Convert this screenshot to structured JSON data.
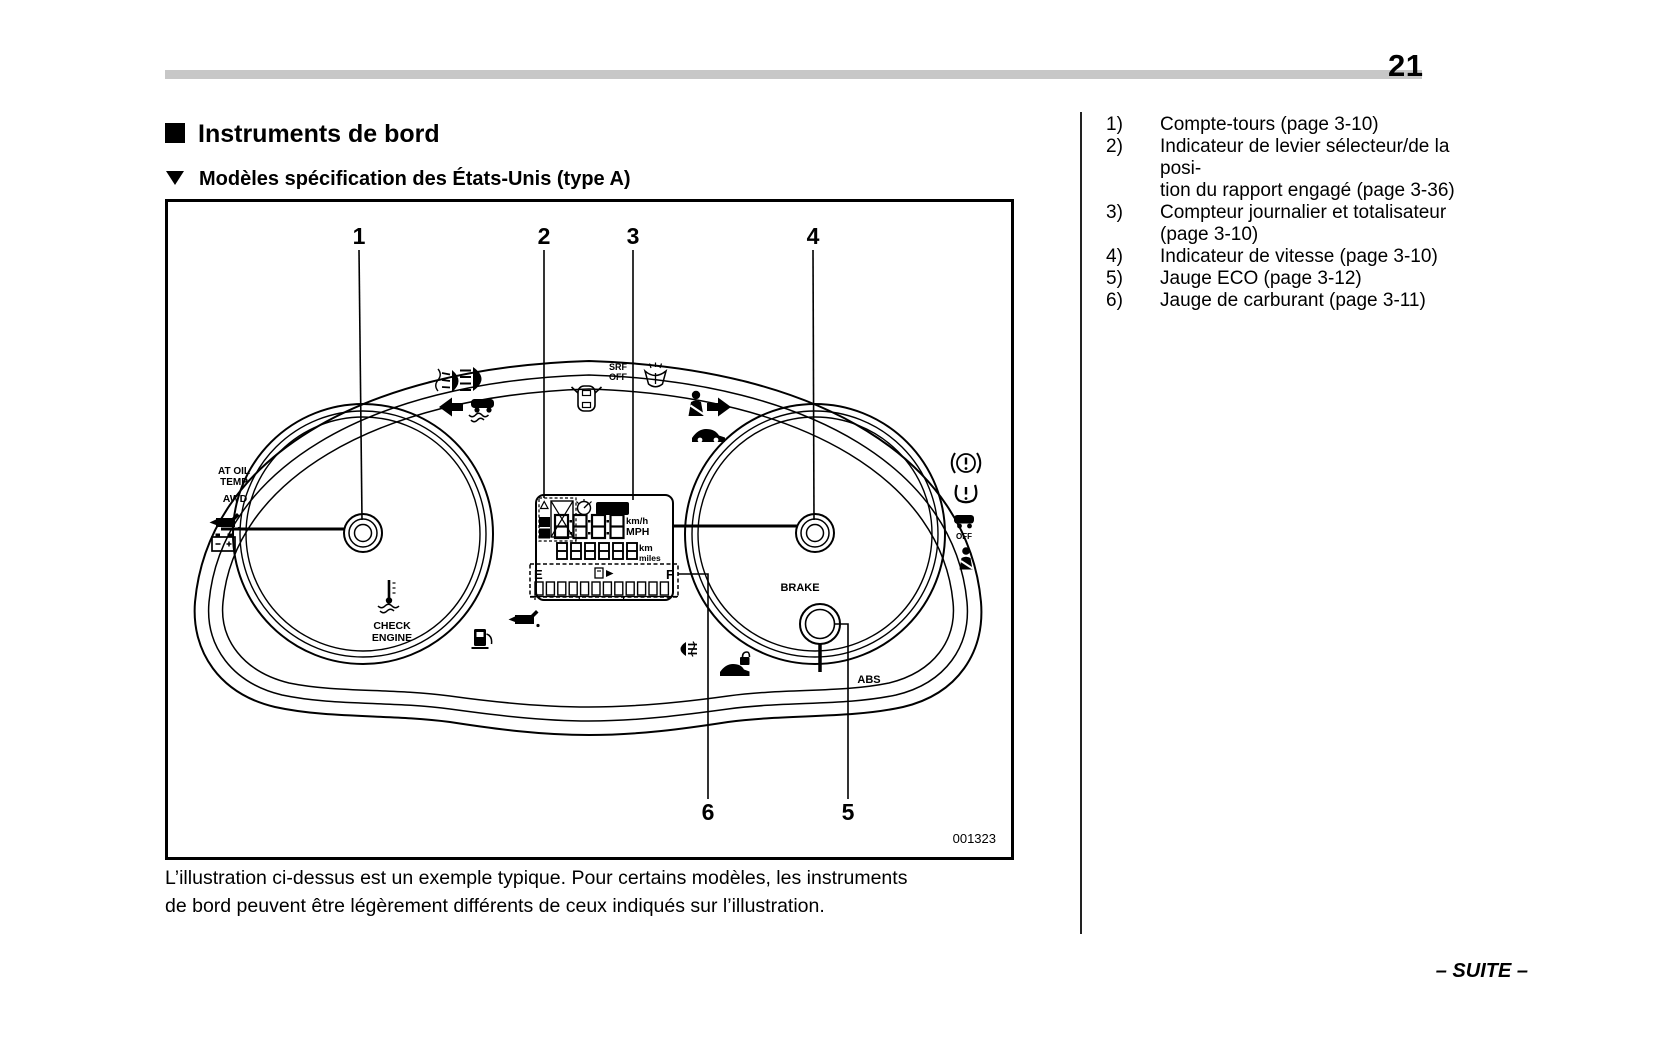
{
  "page": {
    "number": "21"
  },
  "header": {
    "title": "Instruments de bord",
    "subtitle": "Modèles spécification des États-Unis (type A)"
  },
  "figure": {
    "code": "001323",
    "callouts": [
      "1",
      "2",
      "3",
      "4",
      "5",
      "6"
    ],
    "labels": {
      "at_oil": "AT OIL",
      "temp": "TEMP",
      "awd": "AWD",
      "srf": "SRF",
      "srf_off": "OFF",
      "set": "SET",
      "trip_a": "A",
      "trip_b": "B",
      "kmh": "km/h",
      "mph": "MPH",
      "km": "km",
      "miles": "miles",
      "fuel_e": "E",
      "fuel_f": "F",
      "brake": "BRAKE",
      "abs": "ABS",
      "check": "CHECK",
      "engine": "ENGINE",
      "vdc_off": "OFF"
    }
  },
  "caption": {
    "line1": "L’illustration ci-dessus est un exemple typique. Pour certains modèles, les instruments",
    "line2": "de bord peuvent être légèrement différents de ceux indiqués sur l’illustration."
  },
  "reference_list": {
    "items": [
      {
        "num": "1)",
        "lines": [
          "Compte-tours (page 3-10)"
        ]
      },
      {
        "num": "2)",
        "lines": [
          "Indicateur de levier sélecteur/de la posi-",
          "tion du rapport engagé (page 3-36)"
        ]
      },
      {
        "num": "3)",
        "lines": [
          "Compteur journalier et totalisateur",
          "(page 3-10)"
        ]
      },
      {
        "num": "4)",
        "lines": [
          "Indicateur de vitesse (page 3-10)"
        ]
      },
      {
        "num": "5)",
        "lines": [
          "Jauge ECO (page 3-12)"
        ]
      },
      {
        "num": "6)",
        "lines": [
          "Jauge de carburant (page 3-11)"
        ]
      }
    ]
  },
  "footer": {
    "suite": "– SUITE –"
  }
}
